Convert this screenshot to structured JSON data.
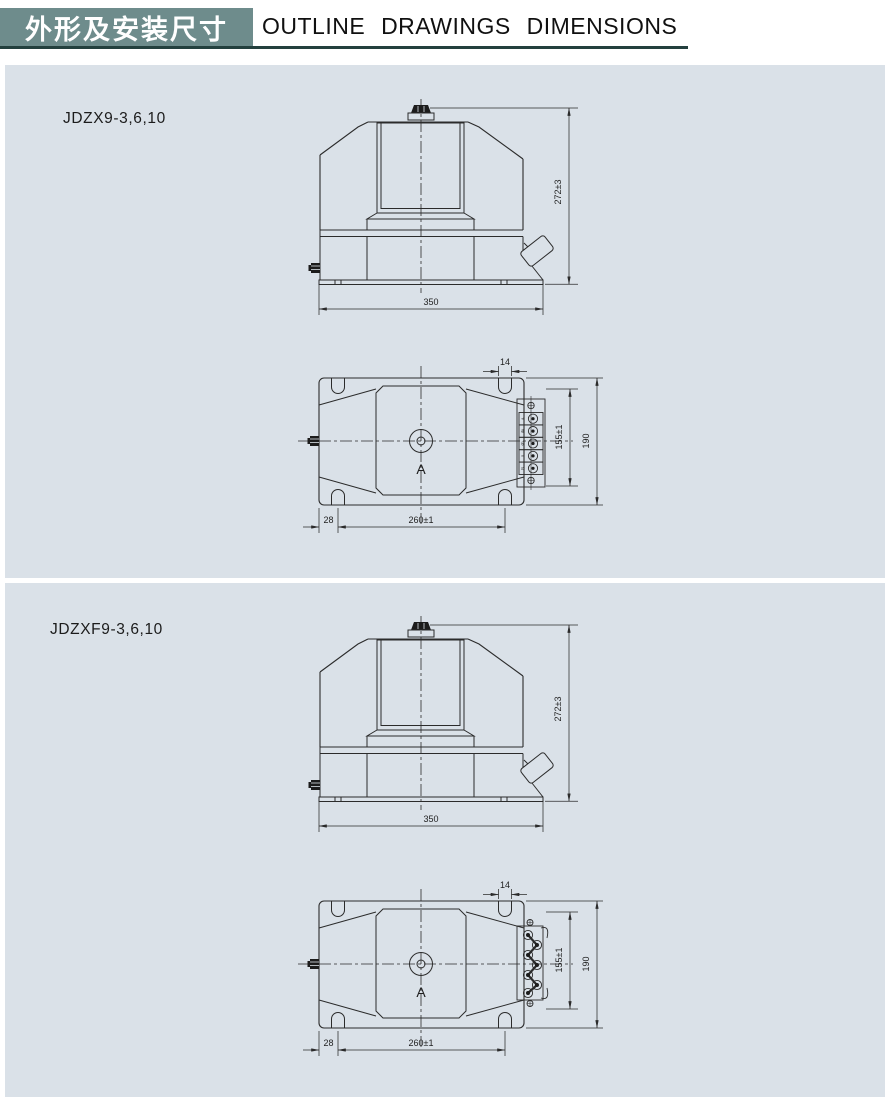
{
  "header": {
    "title_zh": "外形及安装尺寸",
    "title_en": "OUTLINE  DRAWINGS  DIMENSIONS"
  },
  "colors": {
    "accent_teal": "#6e8c8c",
    "underline": "#23403e",
    "panel_background": "#dae1e8",
    "drawing_line": "#2b2b2b"
  },
  "sections": [
    {
      "model": "JDZX9-3,6,10",
      "front": {
        "height": "272±3",
        "base_width": "350"
      },
      "top": {
        "slot_width": "14",
        "slot_pitch_v": "155±1",
        "overall_width": "190",
        "edge_to_slot": "28",
        "slot_pitch_h": "260±1",
        "center_label": "A",
        "terminals": [
          "a",
          "da",
          "dn",
          "n",
          "N"
        ]
      }
    },
    {
      "model": "JDZXF9-3,6,10",
      "front": {
        "height": "272±3",
        "base_width": "350"
      },
      "top": {
        "slot_width": "14",
        "slot_pitch_v": "155±1",
        "overall_width": "190",
        "edge_to_slot": "28",
        "slot_pitch_h": "260±1",
        "center_label": "A"
      }
    }
  ]
}
